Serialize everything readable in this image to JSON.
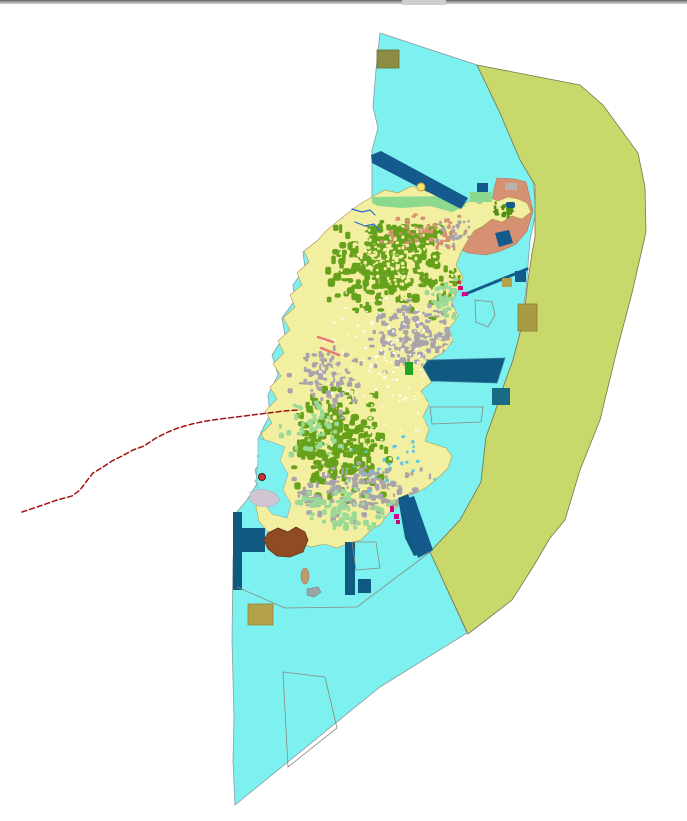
{
  "map": {
    "canvas": {
      "width": 687,
      "height": 821,
      "background": "#ffffff"
    },
    "topbar": {
      "bars": [
        {
          "name": "topbar-dark-line",
          "x": 0,
          "y": 0,
          "w": 687,
          "h": 1.6,
          "fill": "#6f6f6f"
        },
        {
          "name": "topbar-light-line",
          "x": 0,
          "y": 1.6,
          "w": 687,
          "h": 2.2,
          "fill": "#b0b0b0"
        },
        {
          "name": "topbar-notch",
          "x": 402,
          "y": 0,
          "w": 44,
          "h": 5,
          "fill": "#cdcdcd"
        }
      ]
    },
    "palette": {
      "sea": "#7DF0F0",
      "olive_band": "#C9D86A",
      "island_base": "#F2EFA0",
      "forest": "#66A11C",
      "urban": "#A9A4AB",
      "meadow": "#9AD996",
      "salmon": "#D69173",
      "dark_blue": "#155A8C",
      "harbor_blue": "#105A82",
      "mint": "#8CD88C",
      "khaki": "#B3A24A",
      "brown": "#8F4B24",
      "red_dashed": "#A01212",
      "magenta": "#D6008F"
    },
    "regions": [
      {
        "name": "sea-region",
        "fill": "#7DF0F0",
        "stroke": "#8C9CA0",
        "strokeWidth": 0.8,
        "points": "380,33 477,65 500,113 520,158 533,180 536,212 530,240 526,290 520,333 513,360 505,382 495,412 486,437 481,482 460,520 430,552 467,633 380,687 235,805 233,760 234,718 232,640 233,560 236,513 247,500 258,482 255,470 265,455 258,440 262,430 270,415 268,395 278,375 272,355 285,335 282,318 295,300 293,285 305,268 303,252 318,240 330,228 342,218 355,208 365,202 372,197 372,150 378,128 373,107 376,70"
      },
      {
        "name": "olive-buffer-band",
        "fill": "#C9D86A",
        "stroke": "#77774F",
        "strokeWidth": 0.8,
        "points": "477,65 580,85 603,105 638,153 645,187 646,232 632,293 617,350 600,420 580,470 565,520 550,538 533,567 512,600 490,617 468,634 430,552 460,520 481,482 486,437 495,412 505,382 513,360 520,333 525,307 528,280 532,253 535,237 535,185 520,160 500,113"
      },
      {
        "name": "salmon-zone",
        "fill": "#D69173",
        "stroke": "#b5755c",
        "strokeWidth": 0.6,
        "points": "497,178 515,179 526,182 533,211 527,231 516,244 501,251 486,255 468,253 456,247 459,238 471,232 483,227 490,219 492,204 494,189"
      },
      {
        "name": "island-base",
        "clip": true,
        "fill": "#F2EFA0",
        "stroke": "#B49A50",
        "strokeWidth": 0.6,
        "points": "372,197 385,190 398,193 412,186 428,192 443,188 456,195 464,204 472,200 480,204 488,197 498,201 508,197 518,199 527,203 531,212 522,219 512,216 502,222 492,219 483,226 474,231 468,240 461,252 456,265 463,277 458,290 452,303 458,316 449,329 453,341 444,352 432,359 428,366 433,381 421,391 429,404 423,417 429,429 425,441 446,448 452,456 448,468 439,477 427,487 416,493 401,498 397,507 388,514 381,524 371,530 361,540 349,543 337,548 324,544 311,547 299,542 289,537 277,534 267,531 259,521 256,507 263,494 255,481 264,468 257,456 268,446 261,434 272,423 265,411 277,399 270,387 281,376 273,364 284,353 278,341 290,330 283,318 295,307 290,295 302,285 297,273 309,262 304,251 317,241 326,231 338,221 348,213 360,204"
      },
      {
        "name": "mint-shore-band",
        "fill": "#8CD88C",
        "stroke": "none",
        "strokeWidth": 0,
        "points": "372,197 458,196 466,206 452,212 430,206 402,208 378,206 372,203"
      }
    ],
    "speckles": {
      "seed": 1337,
      "clusters": [
        {
          "name": "forest-north",
          "color": "#66A11C",
          "cx": 385,
          "cy": 272,
          "rx": 62,
          "ry": 48,
          "n": 250,
          "smin": 3,
          "smax": 9
        },
        {
          "name": "forest-north-top",
          "color": "#66A11C",
          "cx": 408,
          "cy": 238,
          "rx": 48,
          "ry": 18,
          "n": 80,
          "smin": 3,
          "smax": 8
        },
        {
          "name": "forest-south",
          "color": "#66A11C",
          "cx": 340,
          "cy": 446,
          "rx": 52,
          "ry": 62,
          "n": 230,
          "smin": 3,
          "smax": 9
        },
        {
          "name": "forest-ne",
          "color": "#66A11C",
          "cx": 468,
          "cy": 282,
          "rx": 40,
          "ry": 26,
          "n": 70,
          "smin": 2,
          "smax": 7
        },
        {
          "name": "forest-ne-arm",
          "color": "#4E8F14",
          "cx": 505,
          "cy": 210,
          "rx": 16,
          "ry": 9,
          "n": 22,
          "smin": 2,
          "smax": 5
        },
        {
          "name": "urban-central",
          "color": "#A9A4AB",
          "cx": 420,
          "cy": 335,
          "rx": 55,
          "ry": 40,
          "n": 170,
          "smin": 2,
          "smax": 7
        },
        {
          "name": "urban-south",
          "color": "#A9A4AB",
          "cx": 365,
          "cy": 493,
          "rx": 72,
          "ry": 33,
          "n": 150,
          "smin": 2,
          "smax": 7
        },
        {
          "name": "urban-west",
          "color": "#A9A4AB",
          "cx": 330,
          "cy": 382,
          "rx": 42,
          "ry": 40,
          "n": 100,
          "smin": 2,
          "smax": 6
        },
        {
          "name": "urban-ne-arm",
          "color": "#A9A4AB",
          "cx": 462,
          "cy": 236,
          "rx": 33,
          "ry": 16,
          "n": 55,
          "smin": 2,
          "smax": 5
        },
        {
          "name": "meadow-south",
          "color": "#9AD996",
          "cx": 345,
          "cy": 510,
          "rx": 58,
          "ry": 22,
          "n": 70,
          "smin": 3,
          "smax": 7
        },
        {
          "name": "meadow-mid",
          "color": "#9AD996",
          "cx": 312,
          "cy": 430,
          "rx": 34,
          "ry": 30,
          "n": 50,
          "smin": 3,
          "smax": 6
        },
        {
          "name": "meadow-east",
          "color": "#9AD996",
          "cx": 446,
          "cy": 300,
          "rx": 28,
          "ry": 24,
          "n": 40,
          "smin": 3,
          "smax": 6
        },
        {
          "name": "yellow-overlay",
          "color": "#F4F0A2",
          "cx": 400,
          "cy": 400,
          "rx": 95,
          "ry": 95,
          "n": 220,
          "smin": 2,
          "smax": 5
        },
        {
          "name": "yellow-north",
          "color": "#F4F0A2",
          "cx": 400,
          "cy": 260,
          "rx": 70,
          "ry": 45,
          "n": 150,
          "smin": 2,
          "smax": 4
        },
        {
          "name": "salmon-north",
          "color": "#D69173",
          "cx": 420,
          "cy": 232,
          "rx": 55,
          "ry": 22,
          "n": 60,
          "smin": 2,
          "smax": 5
        },
        {
          "name": "white-specks",
          "color": "#FFFFFF",
          "cx": 395,
          "cy": 360,
          "rx": 85,
          "ry": 85,
          "n": 130,
          "smin": 1,
          "smax": 3
        },
        {
          "name": "blue-specks",
          "color": "#59C8E8",
          "cx": 400,
          "cy": 468,
          "rx": 60,
          "ry": 40,
          "n": 28,
          "smin": 2,
          "smax": 4
        }
      ]
    },
    "features": [
      {
        "type": "polygon",
        "name": "west-lagoon",
        "fill": "#7DF0F0",
        "stroke": "#8C9CA0",
        "strokeWidth": 0.5,
        "points": "258,438 272,442 285,447 280,460 288,474 283,490 291,504 287,518 272,514 262,500 256,481 258,458"
      },
      {
        "type": "polygon",
        "name": "nw-channel-band",
        "fill": "#155A8C",
        "points": "371,155 381,151 468,198 461,209 372,163"
      },
      {
        "type": "rect",
        "name": "mint-square-ne",
        "fill": "#8CD88C",
        "x": 470,
        "y": 192,
        "w": 22,
        "h": 10
      },
      {
        "type": "rect",
        "name": "blue-square-ne",
        "fill": "#155A8C",
        "x": 477,
        "y": 183,
        "w": 11,
        "h": 9
      },
      {
        "type": "rect",
        "name": "salmon-gray-patch",
        "fill": "#B9B3AE",
        "x": 505,
        "y": 183,
        "w": 12,
        "h": 7
      },
      {
        "type": "rect",
        "name": "ne-blue-blob",
        "fill": "#155A8C",
        "x": 506,
        "y": 202,
        "w": 9,
        "h": 6,
        "r": 2
      },
      {
        "type": "polygon",
        "name": "tilted-blue-square",
        "fill": "#155A8C",
        "points": "495,233 509,230 513,243 499,247"
      },
      {
        "type": "polyline",
        "name": "causeway-line",
        "stroke": "#155A8C",
        "strokeWidth": 3,
        "dash": "6,2",
        "points": "463,295 527,269"
      },
      {
        "type": "rect",
        "name": "tan-square-east",
        "fill": "#B3A24A",
        "x": 502,
        "y": 278,
        "w": 10,
        "h": 9
      },
      {
        "type": "rect",
        "name": "blue-square-east",
        "fill": "#155A8C",
        "x": 515,
        "y": 271,
        "w": 11,
        "h": 11
      },
      {
        "type": "rect",
        "name": "khaki-rect-east",
        "fill": "#A89B45",
        "stroke": "#857A36",
        "strokeWidth": 0.8,
        "x": 518,
        "y": 304,
        "w": 19,
        "h": 27
      },
      {
        "type": "polygon",
        "name": "harbor-basin",
        "fill": "#105A82",
        "stroke": "#3E7FA0",
        "strokeWidth": 0.8,
        "points": "423,367 428,360 505,358 497,383 431,381"
      },
      {
        "type": "rect",
        "name": "green-rect-harbor",
        "fill": "#1FA51F",
        "x": 405,
        "y": 362,
        "w": 8,
        "h": 13
      },
      {
        "type": "rect",
        "name": "teal-square-se",
        "fill": "#176B84",
        "x": 492,
        "y": 388,
        "w": 18,
        "h": 17
      },
      {
        "type": "polygon",
        "name": "south-bay-band",
        "fill": "#105A82",
        "points": "398,498 408,494 423,537 427,552 414,556 405,538"
      },
      {
        "type": "polygon",
        "name": "se-channel-band",
        "fill": "#155A8C",
        "points": "399,501 414,496 433,550 418,558"
      },
      {
        "type": "rect",
        "name": "dock-vertical-bar",
        "fill": "#105A82",
        "x": 233,
        "y": 512,
        "w": 9,
        "h": 78
      },
      {
        "type": "rect",
        "name": "dock-horizontal-bar",
        "fill": "#105A82",
        "x": 233,
        "y": 528,
        "w": 32,
        "h": 24
      },
      {
        "type": "rect",
        "name": "blue-bar-south",
        "fill": "#105A82",
        "x": 345,
        "y": 542,
        "w": 10,
        "h": 53
      },
      {
        "type": "rect",
        "name": "blue-square-south",
        "fill": "#105A82",
        "x": 358,
        "y": 579,
        "w": 13,
        "h": 14
      },
      {
        "type": "polygon",
        "name": "brown-islet",
        "fill": "#8F4B24",
        "stroke": "#6B3518",
        "strokeWidth": 0.8,
        "points": "268,533 278,528 288,532 296,527 305,532 308,540 303,552 290,557 277,556 268,549 264,540"
      },
      {
        "type": "ellipse",
        "name": "tan-islet",
        "fill": "#C09A6A",
        "stroke": "#9a7a50",
        "strokeWidth": 0.6,
        "cx": 305,
        "cy": 576,
        "rx": 4,
        "ry": 8
      },
      {
        "type": "polygon",
        "name": "gray-islet",
        "fill": "#9AA5A5",
        "stroke": "#7a8585",
        "strokeWidth": 0.6,
        "points": "307,589 318,587 321,592 314,597 307,595"
      },
      {
        "type": "rect",
        "name": "tan-square-bottom",
        "fill": "#B3A24A",
        "stroke": "#948637",
        "strokeWidth": 0.8,
        "x": 248,
        "y": 604,
        "w": 25,
        "h": 21
      },
      {
        "type": "polygon",
        "name": "lavender-patch",
        "fill": "#CFC6D2",
        "stroke": "#b0a8b5",
        "strokeWidth": 0.6,
        "points": "250,492 262,489 275,493 280,500 272,507 258,506 250,501"
      },
      {
        "type": "rect",
        "name": "dark-khaki-square-top",
        "fill": "#8C8C42",
        "stroke": "#6e6e35",
        "strokeWidth": 0.8,
        "x": 377,
        "y": 50,
        "w": 22,
        "h": 18
      },
      {
        "type": "rect",
        "name": "magenta-speck-1",
        "fill": "#D6008F",
        "x": 390,
        "y": 506,
        "w": 4,
        "h": 6
      },
      {
        "type": "rect",
        "name": "magenta-speck-2",
        "fill": "#D6008F",
        "x": 394,
        "y": 514,
        "w": 5,
        "h": 5
      },
      {
        "type": "rect",
        "name": "magenta-speck-3",
        "fill": "#C80A6E",
        "x": 396,
        "y": 520,
        "w": 4,
        "h": 4
      },
      {
        "type": "rect",
        "name": "magenta-speck-east-1",
        "fill": "#C80A6E",
        "x": 458,
        "y": 286,
        "w": 5,
        "h": 4
      },
      {
        "type": "rect",
        "name": "magenta-speck-east-2",
        "fill": "#D6008F",
        "x": 462,
        "y": 292,
        "w": 6,
        "h": 4
      },
      {
        "type": "rect",
        "name": "red-speck-east",
        "fill": "#E03030",
        "x": 457,
        "y": 281,
        "w": 4,
        "h": 3
      },
      {
        "type": "polyline",
        "name": "river-line-1",
        "stroke": "#2A6AD0",
        "strokeWidth": 1.2,
        "points": "352,209 362,212 370,210 375,215"
      },
      {
        "type": "polyline",
        "name": "river-line-2",
        "stroke": "#2A6AD0",
        "strokeWidth": 1.2,
        "points": "355,222 365,226 374,224 379,230"
      },
      {
        "type": "polyline",
        "name": "pink-road-segment-1",
        "stroke": "#E87878",
        "strokeWidth": 2.5,
        "points": "318,337 333,342"
      },
      {
        "type": "polyline",
        "name": "pink-road-segment-2",
        "stroke": "#E87878",
        "strokeWidth": 2.5,
        "points": "321,348 339,355"
      },
      {
        "type": "polyline",
        "name": "parcel-boundary-line-south",
        "stroke": "#8a8a7a",
        "strokeWidth": 0.8,
        "points": "237,587 285,608 357,607 430,552"
      },
      {
        "type": "polygon",
        "name": "parcel-outline-bottom",
        "fill": "none",
        "stroke": "#8a8a7a",
        "strokeWidth": 0.8,
        "points": "283,672 325,677 337,728 288,767"
      },
      {
        "type": "polygon",
        "name": "parcel-outline-trapezoid",
        "fill": "none",
        "stroke": "#8a8a7a",
        "strokeWidth": 0.8,
        "points": "352,542 376,542 380,568 356,570"
      },
      {
        "type": "polygon",
        "name": "parcel-outline-east",
        "fill": "none",
        "stroke": "#8a8a7a",
        "strokeWidth": 0.8,
        "points": "430,407 483,407 481,422 432,424"
      },
      {
        "type": "polygon",
        "name": "parcel-outline-pentagon",
        "fill": "none",
        "stroke": "#8a8a7a",
        "strokeWidth": 0.8,
        "points": "475,300 492,302 495,315 488,327 476,322"
      },
      {
        "type": "polyline",
        "name": "red-dashed-boundary-line",
        "stroke": "#A01212",
        "strokeWidth": 1.5,
        "dash": "5,3",
        "points": "22,512 40,506 57,500 72,496 80,490 86,482 93,473 103,467 112,461 122,456 133,450 144,446 156,438 168,432 178,428 192,424 206,421 220,419 236,417 252,415 268,413 284,411 298,410"
      },
      {
        "type": "circle",
        "name": "yellow-circle-marker",
        "fill": "#F0E870",
        "stroke": "#C8A030",
        "strokeWidth": 1,
        "cx": 421,
        "cy": 187,
        "r": 4
      },
      {
        "type": "circle",
        "name": "red-point-marker",
        "fill": "#D03030",
        "stroke": "#402020",
        "strokeWidth": 1,
        "cx": 262,
        "cy": 477,
        "r": 3.5
      }
    ]
  }
}
